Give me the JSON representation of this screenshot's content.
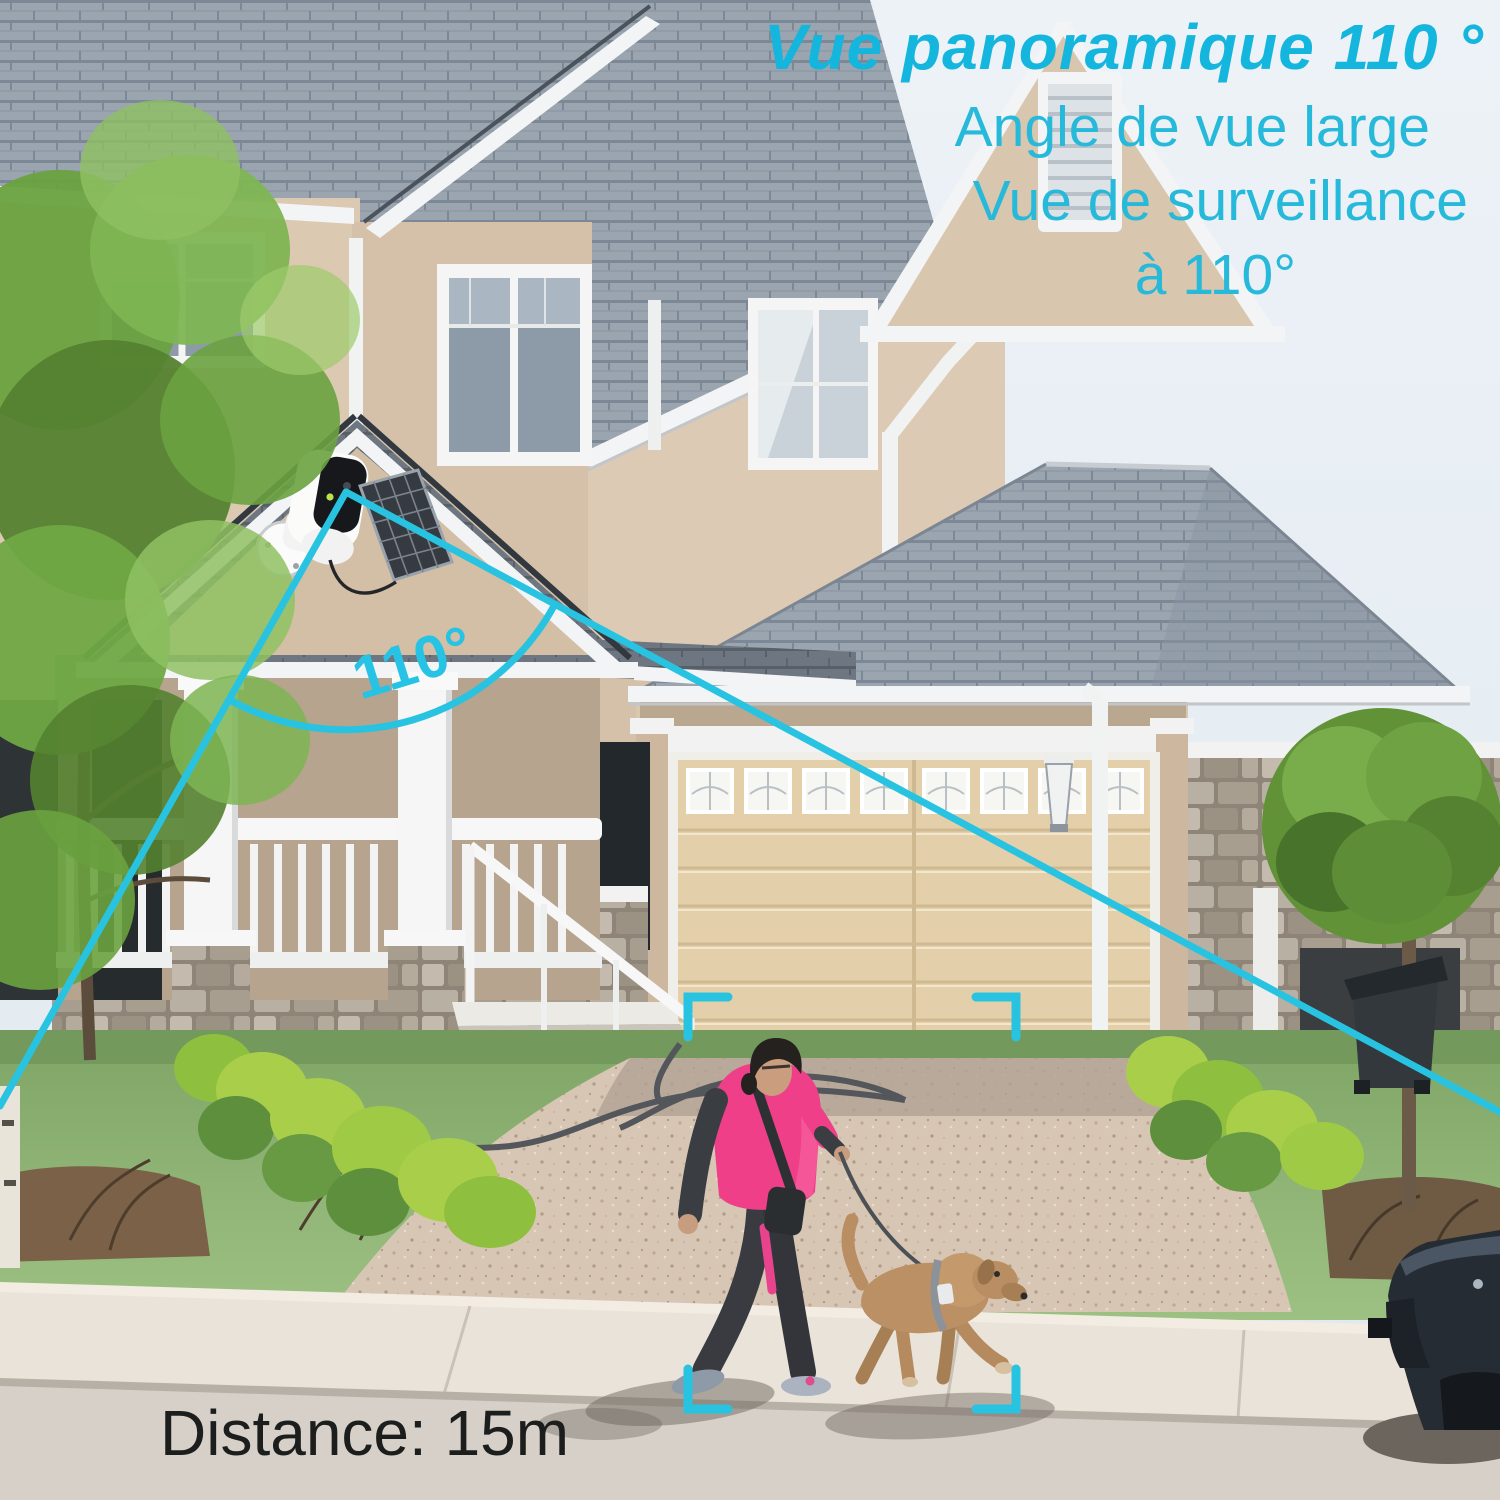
{
  "annotations": {
    "headline": "Vue panoramique 110 °",
    "subline1": "Angle de vue large",
    "subline2": "Vue de surveillance",
    "subline3": "à 110°",
    "fov_angle_label": "110°",
    "distance_label": "Distance: 15m"
  },
  "colors": {
    "accent_text_cyan": "#14b6de",
    "overlay_cyan": "#29c3e2",
    "distance_text": "#1c1e1d",
    "roof_shingle": "#9aa5b0",
    "porch_roof": "#6e7781",
    "wall_tan": "#d9c6af",
    "garage_door": "#e3cfaa",
    "stone": "#b0a698",
    "grass": "#8fb373",
    "bush_lime": "#a9cf4a",
    "driveway": "#d8c6b5",
    "sidewalk": "#e9e3d9",
    "street": "#d6d0c9",
    "jacket_pink": "#ee3f88",
    "dog_tan": "#bb9064",
    "car_dark": "#262c34"
  }
}
